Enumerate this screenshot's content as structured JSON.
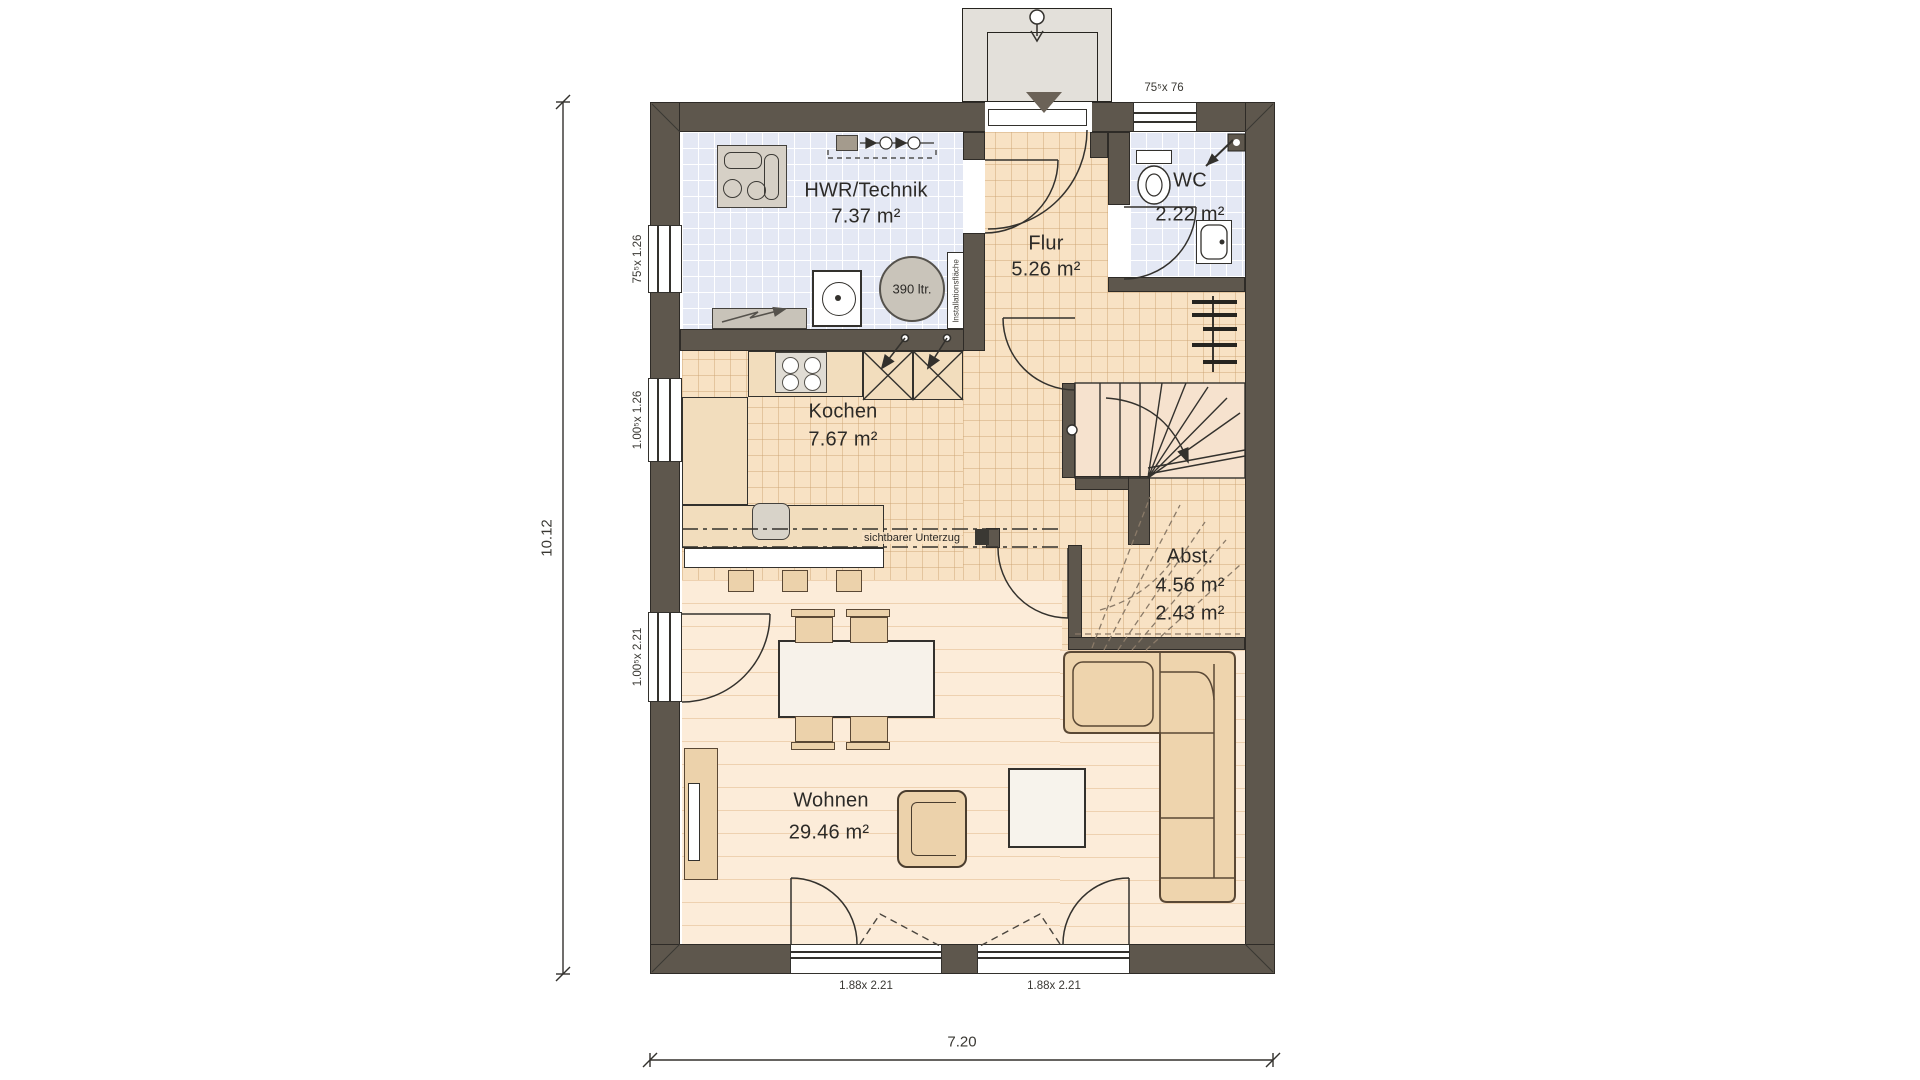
{
  "title": "Erdgeschoss Grundriss",
  "rooms": {
    "hwr": {
      "name": "HWR/Technik",
      "area": "7.37 m²"
    },
    "wc": {
      "name": "WC",
      "area": "2.22 m²"
    },
    "flur": {
      "name": "Flur",
      "area": "5.26 m²"
    },
    "kochen": {
      "name": "Kochen",
      "area": "7.67 m²"
    },
    "abst": {
      "name": "Abst.",
      "area": "4.56 m²",
      "area2": "2.43 m²"
    },
    "wohnen": {
      "name": "Wohnen",
      "area": "29.46 m²"
    }
  },
  "annotations": {
    "tank": "390 ltr.",
    "beam": "sichtbarer Unterzug",
    "installation": "Installationsfläche"
  },
  "dimensions": {
    "overall_width": "7.20",
    "overall_height": "10.12",
    "window_hwr": "75⁵x 1.26",
    "window_kochen": "1.00⁵x 1.26",
    "window_wohnen": "1.00⁵x 2.21",
    "door_terrace_left": "1.88x 2.21",
    "door_terrace_right": "1.88x 2.21",
    "window_wc": "75⁵x 76"
  },
  "colors": {
    "wall": "#5e574d",
    "wallline": "#2e2b27",
    "bluetile": "#e4e8f4",
    "bluegrid": "#ffffff",
    "peach": "#f8e2c4",
    "peachline": "rgba(203,162,112,0.45)",
    "plank": "#fcecd9",
    "plankline": "rgba(226,188,142,0.55)",
    "ink": "#33312d",
    "tan": "#ecd2ab",
    "tanline": "#5a4835",
    "gray": "#d6d0c6",
    "cream": "#f7f2ea",
    "porch": "#e3e0da"
  }
}
